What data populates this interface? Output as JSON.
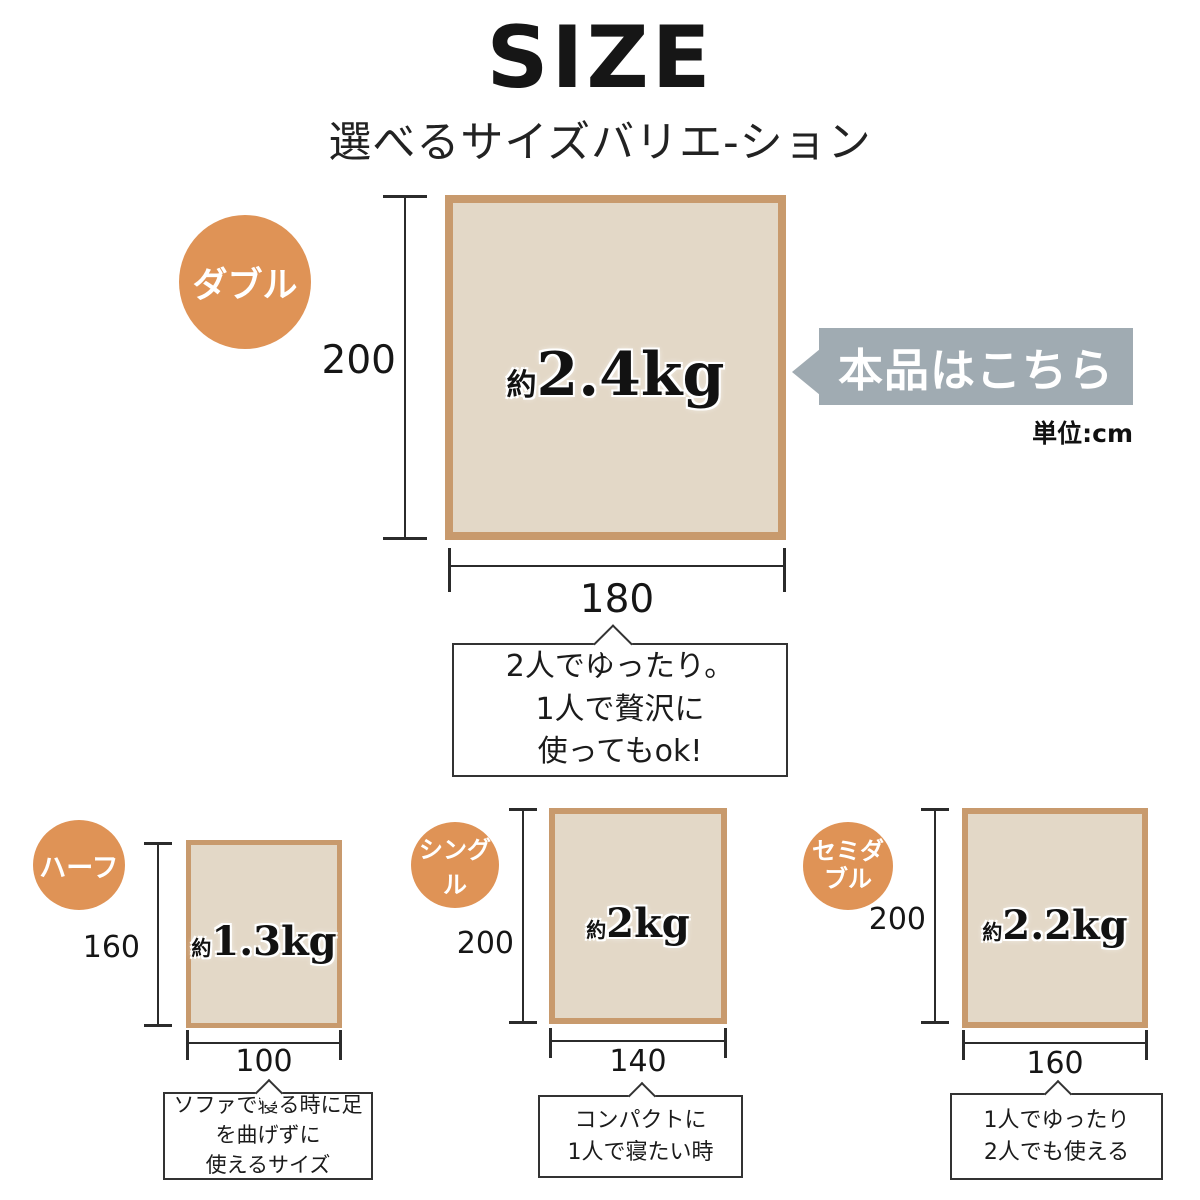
{
  "title": "SIZE",
  "subtitle": "選べるサイズバリエ-ション",
  "callout_label": "本品はこちら",
  "unit_note": "単位:cm",
  "colors": {
    "accent_orange": "#df9356",
    "rect_fill": "#e3d8c7",
    "rect_border": "#c89a6d",
    "callout_gray": "#a0abb2",
    "line": "#2b2b2b"
  },
  "sizes": {
    "double": {
      "badge": "ダブル",
      "height": "200",
      "width": "180",
      "weight_prefix": "約",
      "weight_value": "2.4kg",
      "note_line1": "2人でゆったり。",
      "note_line2": "1人で贅沢に",
      "note_line3": "使ってもok!"
    },
    "half": {
      "badge": "ハーフ",
      "height": "160",
      "width": "100",
      "weight_prefix": "約",
      "weight_value": "1.3kg",
      "note_line1": "ソファで寝る時に足",
      "note_line2": "を曲げずに",
      "note_line3": "使えるサイズ"
    },
    "single": {
      "badge": "シングル",
      "height": "200",
      "width": "140",
      "weight_prefix": "約",
      "weight_value": "2kg",
      "note_line1": "コンパクトに",
      "note_line2": "1人で寝たい時"
    },
    "semi_double": {
      "badge_line1": "セミダ",
      "badge_line2": "ブル",
      "height": "200",
      "width": "160",
      "weight_prefix": "約",
      "weight_value": "2.2kg",
      "note_line1": "1人でゆったり",
      "note_line2": "2人でも使える"
    }
  }
}
